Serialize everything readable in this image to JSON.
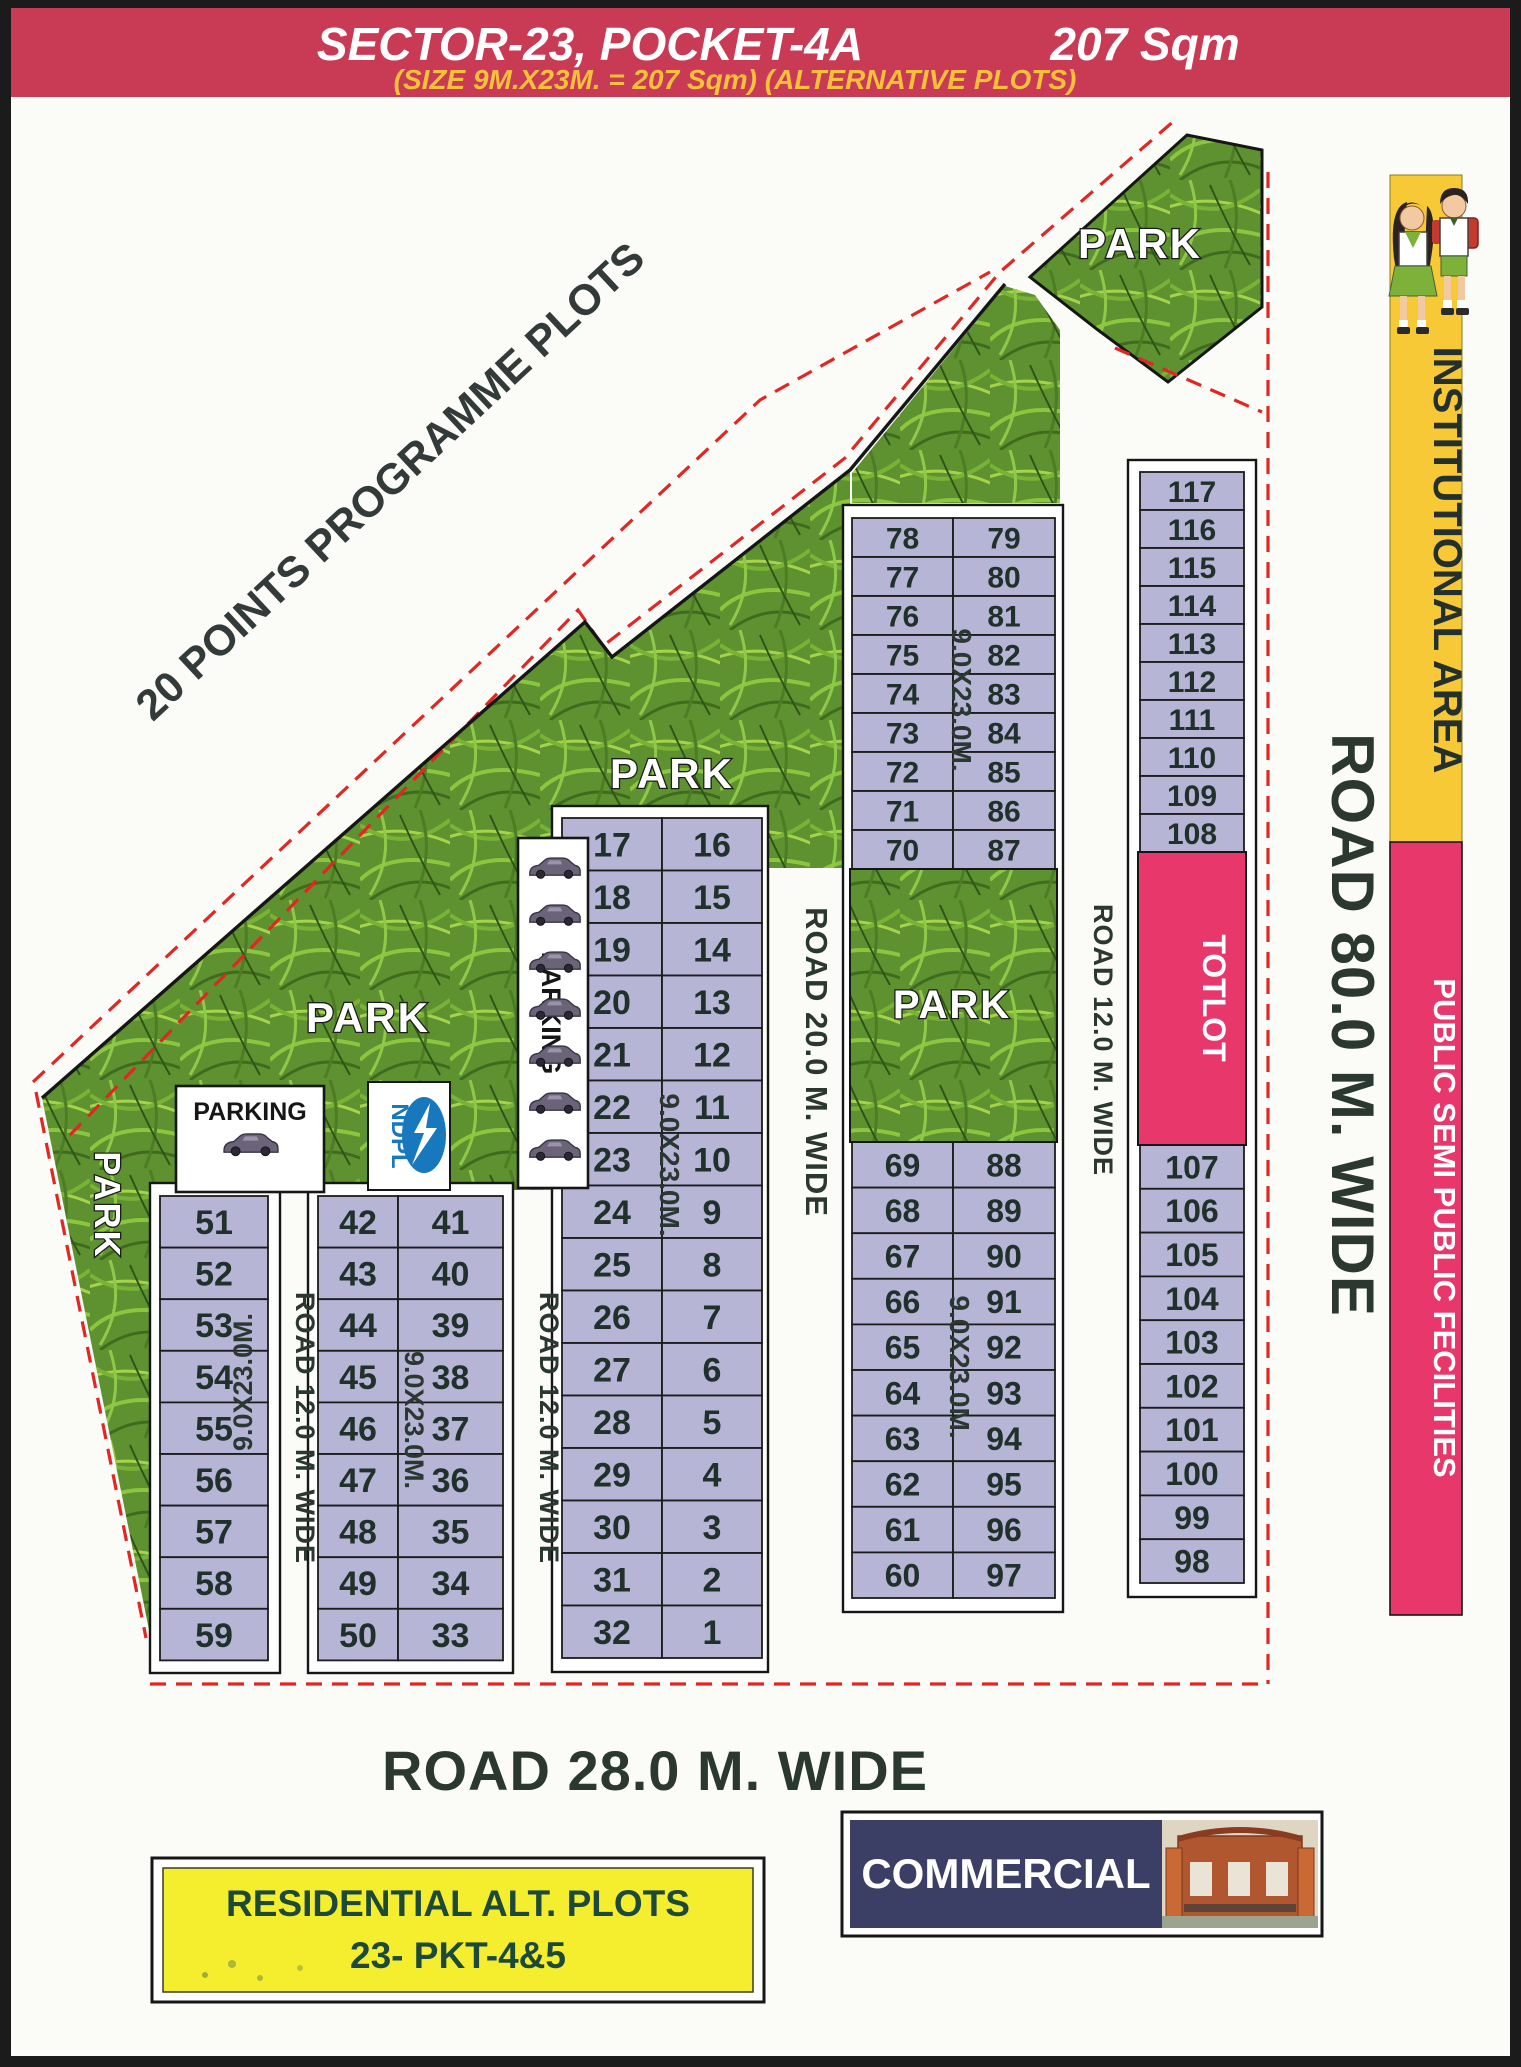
{
  "header": {
    "title": "SECTOR-23, POCKET-4A",
    "area": "207 Sqm",
    "subtitle": "(SIZE 9M.X23M. = 207 Sqm) (ALTERNATIVE PLOTS)"
  },
  "labels": {
    "programme": "20 POINTS PROGRAMME PLOTS",
    "park": "PARK",
    "parking": "PARKING",
    "totlot": "TOTLOT",
    "ndpl": "NDPL",
    "plot_size": "9.0X23.0M.",
    "institutional": "INSTITUTIONAL AREA",
    "public_semi": "PUBLIC SEMI PUBLIC FECILITIES"
  },
  "roads": {
    "r12": "ROAD 12.0 M. WIDE",
    "r20": "ROAD 20.0 M. WIDE",
    "r28": "ROAD 28.0 M. WIDE",
    "r80": "ROAD 80.0 M. WIDE"
  },
  "legend": {
    "residential_line1": "RESIDENTIAL  ALT.  PLOTS",
    "residential_line2": "23- PKT-4&5",
    "commercial": "COMMERCIAL"
  },
  "plot_blocks": {
    "block_51": {
      "rows": [
        "51",
        "52",
        "53",
        "54",
        "55",
        "56",
        "57",
        "58",
        "59"
      ]
    },
    "block_42": {
      "left": [
        "42",
        "43",
        "44",
        "45",
        "46",
        "47",
        "48",
        "49",
        "50"
      ],
      "right": [
        "41",
        "40",
        "39",
        "38",
        "37",
        "36",
        "35",
        "34",
        "33"
      ]
    },
    "block_17": {
      "left": [
        "17",
        "18",
        "19",
        "20",
        "21",
        "22",
        "23",
        "24",
        "25",
        "26",
        "27",
        "28",
        "29",
        "30",
        "31",
        "32"
      ],
      "right": [
        "16",
        "15",
        "14",
        "13",
        "12",
        "11",
        "10",
        "9",
        "8",
        "7",
        "6",
        "5",
        "4",
        "3",
        "2",
        "1"
      ]
    },
    "block_78": {
      "left_top": [
        "78",
        "77",
        "76",
        "75",
        "74",
        "73",
        "72",
        "71",
        "70"
      ],
      "right_top": [
        "79",
        "80",
        "81",
        "82",
        "83",
        "84",
        "85",
        "86",
        "87"
      ],
      "left_bottom": [
        "69",
        "68",
        "67",
        "66",
        "65",
        "64",
        "63",
        "62",
        "61",
        "60"
      ],
      "right_bottom": [
        "88",
        "89",
        "90",
        "91",
        "92",
        "93",
        "94",
        "95",
        "96",
        "97"
      ]
    },
    "block_117": {
      "top": [
        "117",
        "116",
        "115",
        "114",
        "113",
        "112",
        "111",
        "110",
        "109",
        "108"
      ],
      "bottom": [
        "107",
        "106",
        "105",
        "104",
        "103",
        "102",
        "101",
        "100",
        "99",
        "98"
      ]
    }
  },
  "colors": {
    "header_bg": "#c93a54",
    "header_title": "#ffffff",
    "header_subtitle": "#f6c03c",
    "plot_fill": "#b6b5d6",
    "park_green": "#5e9130",
    "red_dash": "#e02724",
    "totlot_pink": "#e8386b",
    "institutional_yellow": "#f8c937",
    "public_pink": "#e8386b",
    "commercial_navy": "#3b3f66",
    "residential_yellow": "#f4ee2f",
    "ndpl_blue": "#1878be"
  }
}
